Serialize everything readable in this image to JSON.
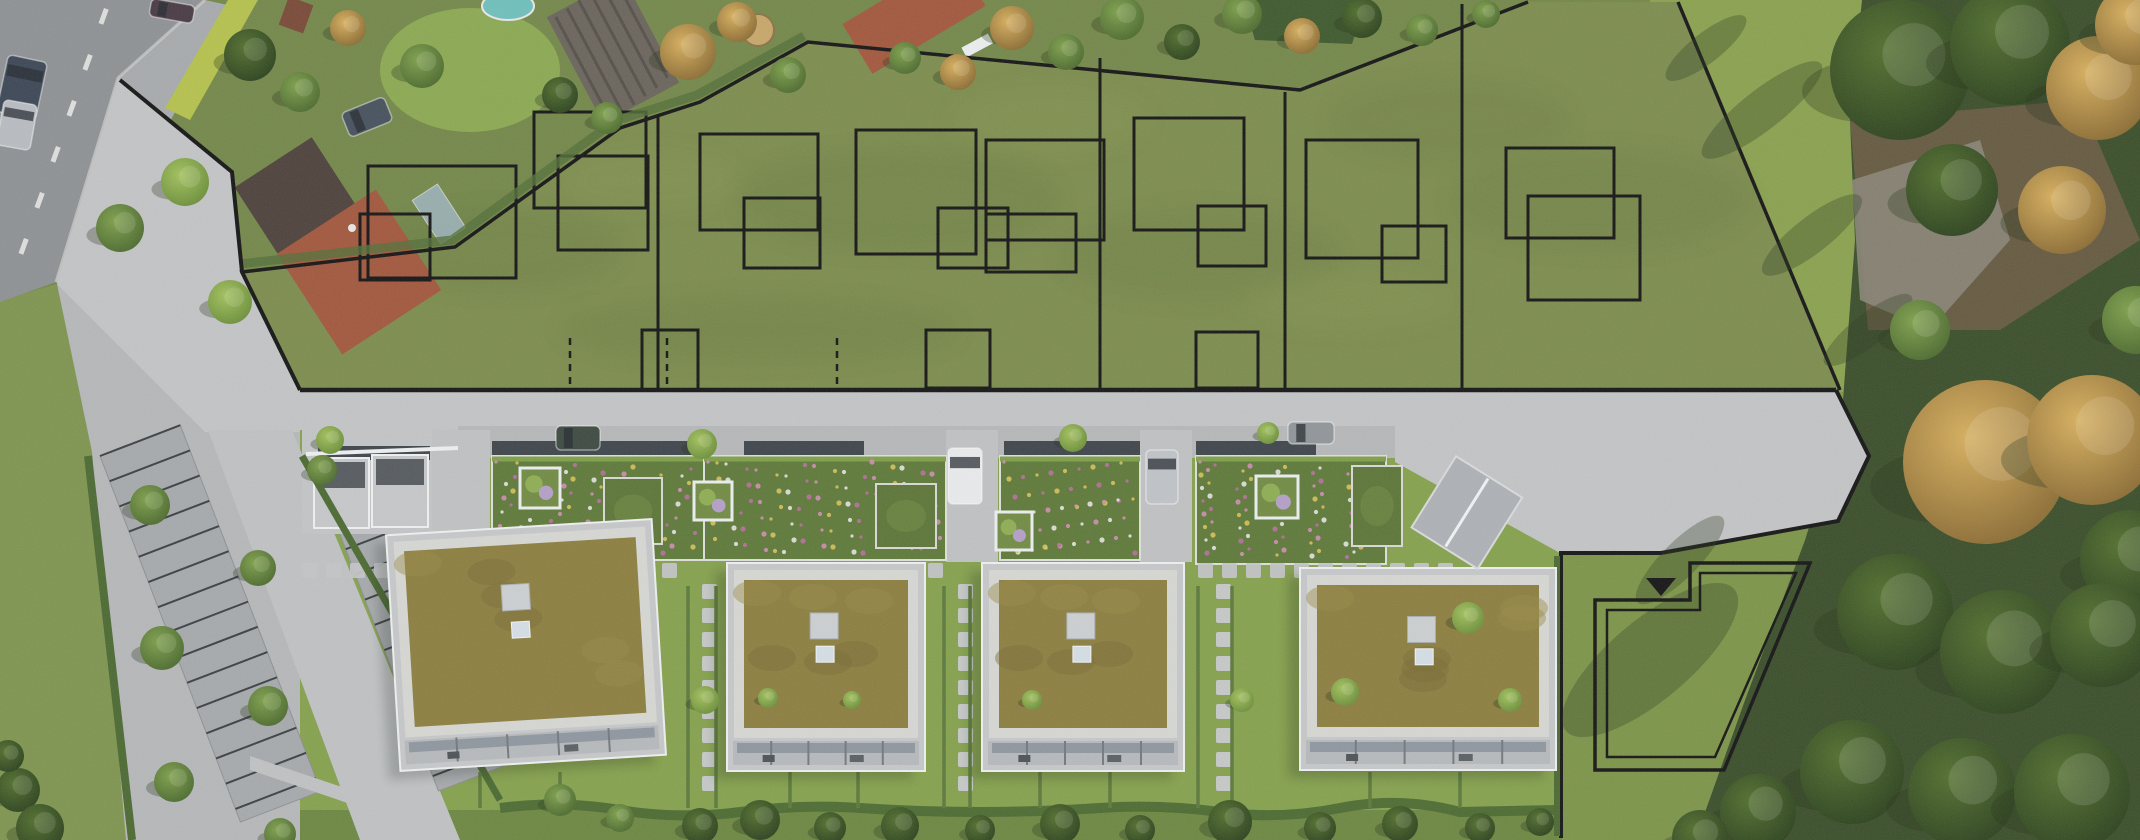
{
  "meta": {
    "description": "Aerial drone photograph of a new housing development: four flat-roof buildings with green sedum roofs along a new access road, a large olive-tinted field behind them overlaid with black plot boundaries and house footprint outlines, existing houses and gardens top-left, parking rows bottom-left, autumn woods on the right, and one reserved plot marked with a double outline and a triangle marker.",
    "image_type": "aerial-photograph-with-site-plan-overlay",
    "building_count": 4,
    "marked_plot_columns": 6
  },
  "palette": {
    "asphalt": "#8f9295",
    "shoulder": "#9a9a8a",
    "sidewalk": "#a8abae",
    "pavement": "#c4c5c7",
    "pavementDim": "#b6b8ba",
    "driveGray": "#c0c2c4",
    "field": "#7d8d4e",
    "gardenBase": "#74884a",
    "lawn": "#7f9550",
    "gardenLawn": "#86a24e",
    "meadow": "#8ba24f",
    "rightLawn": "#7d9549",
    "bottomStrip": "#6d8842",
    "sedum": "#8d7f40",
    "gravel": "#d7d8d4",
    "facade": "#c6c8ca",
    "glass": "#8b949c",
    "flower": "#5f7a3a",
    "hedge": "#4c6a32",
    "hedgeBright": "#b6c24e",
    "woods": "#3b4f2b",
    "rock": "#8a8578",
    "soil": "#6b5b44",
    "stall": "#a7aaad",
    "stallLine": "#3c4043",
    "line": "#161616",
    "white": "#eceff0",
    "pool": "#6fc0bc",
    "roofRed": "#a3583e",
    "roofDark": "#4e423c"
  },
  "scene": {
    "field_outline": "300,390 242,272 455,247 620,128 700,102 808,42 1300,90 1528,2 1678,2 1840,390",
    "plot_dividers": [
      {
        "x1": 658,
        "y1": 114,
        "x2": 658,
        "y2": 390
      },
      {
        "x1": 1100,
        "y1": 58,
        "x2": 1100,
        "y2": 390
      },
      {
        "x1": 1285,
        "y1": 92,
        "x2": 1285,
        "y2": 390
      },
      {
        "x1": 1462,
        "y1": 4,
        "x2": 1462,
        "y2": 390
      }
    ],
    "plot_dividers_dashed": [
      {
        "x1": 570,
        "y1": 338,
        "x2": 570,
        "y2": 390
      },
      {
        "x1": 667,
        "y1": 338,
        "x2": 667,
        "y2": 390
      },
      {
        "x1": 837,
        "y1": 338,
        "x2": 837,
        "y2": 390
      }
    ],
    "footprints": [
      {
        "x": 368,
        "y": 166,
        "w": 148,
        "h": 112
      },
      {
        "x": 360,
        "y": 214,
        "w": 70,
        "h": 66
      },
      {
        "x": 534,
        "y": 112,
        "w": 112,
        "h": 96
      },
      {
        "x": 558,
        "y": 156,
        "w": 90,
        "h": 94
      },
      {
        "x": 642,
        "y": 330,
        "w": 56,
        "h": 60
      },
      {
        "x": 700,
        "y": 134,
        "w": 118,
        "h": 96
      },
      {
        "x": 744,
        "y": 198,
        "w": 76,
        "h": 70
      },
      {
        "x": 856,
        "y": 130,
        "w": 120,
        "h": 124
      },
      {
        "x": 938,
        "y": 208,
        "w": 70,
        "h": 60
      },
      {
        "x": 926,
        "y": 330,
        "w": 64,
        "h": 58
      },
      {
        "x": 986,
        "y": 140,
        "w": 118,
        "h": 100
      },
      {
        "x": 986,
        "y": 214,
        "w": 90,
        "h": 58
      },
      {
        "x": 1134,
        "y": 118,
        "w": 110,
        "h": 112
      },
      {
        "x": 1198,
        "y": 206,
        "w": 68,
        "h": 60
      },
      {
        "x": 1196,
        "y": 332,
        "w": 62,
        "h": 56
      },
      {
        "x": 1306,
        "y": 140,
        "w": 112,
        "h": 118
      },
      {
        "x": 1382,
        "y": 226,
        "w": 64,
        "h": 56
      },
      {
        "x": 1506,
        "y": 148,
        "w": 108,
        "h": 90
      },
      {
        "x": 1528,
        "y": 196,
        "w": 112,
        "h": 104
      }
    ],
    "buildings": [
      {
        "x": 393,
        "y": 527,
        "w": 266,
        "h": 236,
        "rot": -3.5,
        "name": "building-1"
      },
      {
        "x": 727,
        "y": 563,
        "w": 198,
        "h": 208,
        "rot": 0,
        "name": "building-2"
      },
      {
        "x": 982,
        "y": 563,
        "w": 202,
        "h": 208,
        "rot": 0,
        "name": "building-3"
      },
      {
        "x": 1300,
        "y": 568,
        "w": 256,
        "h": 202,
        "rot": 0,
        "name": "building-4"
      }
    ],
    "flower_roofs": [
      {
        "x": 492,
        "y": 456,
        "w": 212,
        "h": 104
      },
      {
        "x": 704,
        "y": 456,
        "w": 242,
        "h": 104
      },
      {
        "x": 1000,
        "y": 456,
        "w": 140,
        "h": 104
      },
      {
        "x": 1196,
        "y": 456,
        "w": 190,
        "h": 108
      }
    ],
    "green_roofs": [
      {
        "x": 604,
        "y": 478,
        "w": 58,
        "h": 66
      },
      {
        "x": 876,
        "y": 484,
        "w": 60,
        "h": 64
      },
      {
        "x": 1352,
        "y": 466,
        "w": 50,
        "h": 80
      }
    ],
    "planters": [
      {
        "x": 520,
        "y": 468,
        "w": 40,
        "h": 40
      },
      {
        "x": 694,
        "y": 482,
        "w": 38,
        "h": 38
      },
      {
        "x": 996,
        "y": 512,
        "w": 36,
        "h": 38
      },
      {
        "x": 1256,
        "y": 476,
        "w": 42,
        "h": 42
      }
    ],
    "fences": [
      {
        "x": 492,
        "y": 441,
        "w": 210
      },
      {
        "x": 744,
        "y": 441,
        "w": 120
      },
      {
        "x": 1004,
        "y": 441,
        "w": 136
      },
      {
        "x": 1196,
        "y": 441,
        "w": 120
      },
      {
        "x": 318,
        "y": 446,
        "w": 112
      }
    ],
    "driveways": [
      {
        "x": 432,
        "y": 430,
        "w": 58,
        "h": 132
      },
      {
        "x": 946,
        "y": 430,
        "w": 52,
        "h": 132
      },
      {
        "x": 1140,
        "y": 430,
        "w": 52,
        "h": 132
      }
    ],
    "carports": [
      {
        "x": 314,
        "y": 458,
        "w": 55,
        "h": 70
      },
      {
        "x": 372,
        "y": 455,
        "w": 56,
        "h": 72
      }
    ],
    "paver_rows": {
      "y": 563,
      "size": 15,
      "gap": 24,
      "segments": [
        [
          302,
          700
        ],
        [
          760,
          948
        ],
        [
          1002,
          1144
        ],
        [
          1198,
          1456
        ]
      ]
    },
    "paver_paths": [
      {
        "x": 702,
        "y1": 584,
        "y2": 806
      },
      {
        "x": 958,
        "y1": 584,
        "y2": 806
      },
      {
        "x": 1216,
        "y1": 584,
        "y2": 806
      }
    ],
    "unit_hedges": [
      {
        "x": 688,
        "y1": 586,
        "y2": 808
      },
      {
        "x": 716,
        "y1": 586,
        "y2": 808
      },
      {
        "x": 944,
        "y1": 586,
        "y2": 808
      },
      {
        "x": 970,
        "y1": 586,
        "y2": 808
      },
      {
        "x": 1198,
        "y1": 586,
        "y2": 808
      },
      {
        "x": 1232,
        "y1": 586,
        "y2": 808
      },
      {
        "x": 480,
        "y1": 772,
        "y2": 808
      },
      {
        "x": 560,
        "y1": 772,
        "y2": 808
      },
      {
        "x": 790,
        "y1": 772,
        "y2": 808
      },
      {
        "x": 858,
        "y1": 772,
        "y2": 808
      },
      {
        "x": 1040,
        "y1": 772,
        "y2": 808
      },
      {
        "x": 1110,
        "y1": 772,
        "y2": 808
      },
      {
        "x": 1370,
        "y1": 772,
        "y2": 808
      },
      {
        "x": 1460,
        "y1": 772,
        "y2": 808
      }
    ],
    "stall_rows": [
      {
        "x": 100,
        "y": 456,
        "w": 86,
        "len": 392,
        "angle": -21,
        "sp": 27
      },
      {
        "x": 336,
        "y": 524,
        "w": 80,
        "len": 286,
        "angle": -21,
        "sp": 27
      }
    ],
    "road_dashes": [
      {
        "x": 104,
        "y": 8
      },
      {
        "x": 88,
        "y": 54
      },
      {
        "x": 72,
        "y": 100
      },
      {
        "x": 56,
        "y": 146
      },
      {
        "x": 40,
        "y": 192
      },
      {
        "x": 24,
        "y": 238
      }
    ],
    "cars": [
      {
        "x": 150,
        "y": 2,
        "w": 44,
        "h": 18,
        "r": 10,
        "o": "h",
        "c": "#4a3b45",
        "name": "car-maroon-road-top"
      },
      {
        "x": 2,
        "y": 58,
        "w": 40,
        "h": 58,
        "r": 12,
        "o": "v",
        "c": "#3c4756",
        "name": "van-dark-road"
      },
      {
        "x": 0,
        "y": 102,
        "w": 34,
        "h": 46,
        "r": 10,
        "o": "v",
        "c": "#b9bdc2",
        "name": "car-silver-road"
      },
      {
        "x": 344,
        "y": 104,
        "w": 46,
        "h": 26,
        "r": -22,
        "o": "h",
        "c": "#47525e",
        "name": "van-house-driveway"
      },
      {
        "x": 556,
        "y": 426,
        "w": 44,
        "h": 24,
        "r": 0,
        "o": "h",
        "c": "#3e4a42",
        "name": "car-green-parked"
      },
      {
        "x": 948,
        "y": 448,
        "w": 34,
        "h": 56,
        "r": 0,
        "o": "v",
        "c": "#e9ebed",
        "name": "car-white-driveway"
      },
      {
        "x": 1146,
        "y": 450,
        "w": 32,
        "h": 54,
        "r": 0,
        "o": "v",
        "c": "#c0c4c8",
        "name": "car-silver-driveway"
      },
      {
        "x": 1288,
        "y": 422,
        "w": 46,
        "h": 22,
        "r": 0,
        "o": "h",
        "c": "#91969b",
        "name": "car-gray-road"
      }
    ],
    "trees": [
      {
        "x": 250,
        "y": 55,
        "r": 26,
        "k": "d"
      },
      {
        "x": 300,
        "y": 92,
        "r": 20,
        "k": "g"
      },
      {
        "x": 348,
        "y": 28,
        "r": 18,
        "k": "a"
      },
      {
        "x": 422,
        "y": 66,
        "r": 22,
        "k": "g"
      },
      {
        "x": 560,
        "y": 95,
        "r": 18,
        "k": "d"
      },
      {
        "x": 607,
        "y": 118,
        "r": 16,
        "k": "g"
      },
      {
        "x": 688,
        "y": 52,
        "r": 28,
        "k": "a"
      },
      {
        "x": 737,
        "y": 22,
        "r": 20,
        "k": "a"
      },
      {
        "x": 788,
        "y": 75,
        "r": 18,
        "k": "g"
      },
      {
        "x": 905,
        "y": 58,
        "r": 16,
        "k": "g"
      },
      {
        "x": 958,
        "y": 72,
        "r": 18,
        "k": "a"
      },
      {
        "x": 1012,
        "y": 28,
        "r": 22,
        "k": "a"
      },
      {
        "x": 1066,
        "y": 52,
        "r": 18,
        "k": "g"
      },
      {
        "x": 1122,
        "y": 18,
        "r": 22,
        "k": "g"
      },
      {
        "x": 1182,
        "y": 42,
        "r": 18,
        "k": "d"
      },
      {
        "x": 1242,
        "y": 14,
        "r": 20,
        "k": "g"
      },
      {
        "x": 1302,
        "y": 36,
        "r": 18,
        "k": "a"
      },
      {
        "x": 1362,
        "y": 18,
        "r": 20,
        "k": "d"
      },
      {
        "x": 1422,
        "y": 30,
        "r": 16,
        "k": "g"
      },
      {
        "x": 1486,
        "y": 14,
        "r": 14,
        "k": "g"
      },
      {
        "x": 185,
        "y": 182,
        "r": 24,
        "k": "b"
      },
      {
        "x": 120,
        "y": 228,
        "r": 24,
        "k": "g"
      },
      {
        "x": 230,
        "y": 302,
        "r": 22,
        "k": "b"
      },
      {
        "x": 150,
        "y": 505,
        "r": 20,
        "k": "g"
      },
      {
        "x": 162,
        "y": 648,
        "r": 22,
        "k": "g"
      },
      {
        "x": 174,
        "y": 782,
        "r": 20,
        "k": "g"
      },
      {
        "x": 258,
        "y": 568,
        "r": 18,
        "k": "g"
      },
      {
        "x": 268,
        "y": 706,
        "r": 20,
        "k": "g"
      },
      {
        "x": 280,
        "y": 834,
        "r": 16,
        "k": "g"
      },
      {
        "x": 322,
        "y": 470,
        "r": 15,
        "k": "g"
      },
      {
        "x": 330,
        "y": 440,
        "r": 14,
        "k": "b"
      },
      {
        "x": 702,
        "y": 444,
        "r": 15,
        "k": "b"
      },
      {
        "x": 1073,
        "y": 438,
        "r": 14,
        "k": "b"
      },
      {
        "x": 1268,
        "y": 433,
        "r": 11,
        "k": "b"
      },
      {
        "x": 705,
        "y": 700,
        "r": 14,
        "k": "b"
      },
      {
        "x": 768,
        "y": 698,
        "r": 10,
        "k": "b"
      },
      {
        "x": 852,
        "y": 700,
        "r": 9,
        "k": "b"
      },
      {
        "x": 1032,
        "y": 700,
        "r": 10,
        "k": "b"
      },
      {
        "x": 1242,
        "y": 700,
        "r": 12,
        "k": "b"
      },
      {
        "x": 1345,
        "y": 692,
        "r": 14,
        "k": "b"
      },
      {
        "x": 1468,
        "y": 618,
        "r": 16,
        "k": "b"
      },
      {
        "x": 1510,
        "y": 700,
        "r": 12,
        "k": "b"
      },
      {
        "x": 560,
        "y": 800,
        "r": 16,
        "k": "g"
      },
      {
        "x": 620,
        "y": 818,
        "r": 14,
        "k": "g"
      },
      {
        "x": 700,
        "y": 826,
        "r": 18,
        "k": "d"
      },
      {
        "x": 760,
        "y": 820,
        "r": 20,
        "k": "d"
      },
      {
        "x": 830,
        "y": 828,
        "r": 16,
        "k": "d"
      },
      {
        "x": 900,
        "y": 826,
        "r": 19,
        "k": "d"
      },
      {
        "x": 980,
        "y": 830,
        "r": 15,
        "k": "d"
      },
      {
        "x": 1060,
        "y": 824,
        "r": 20,
        "k": "d"
      },
      {
        "x": 1140,
        "y": 830,
        "r": 15,
        "k": "d"
      },
      {
        "x": 1230,
        "y": 822,
        "r": 22,
        "k": "d"
      },
      {
        "x": 1320,
        "y": 828,
        "r": 16,
        "k": "d"
      },
      {
        "x": 1400,
        "y": 824,
        "r": 18,
        "k": "d"
      },
      {
        "x": 1480,
        "y": 828,
        "r": 15,
        "k": "d"
      },
      {
        "x": 1540,
        "y": 822,
        "r": 14,
        "k": "d"
      },
      {
        "x": 1900,
        "y": 70,
        "r": 70,
        "k": "d"
      },
      {
        "x": 2010,
        "y": 45,
        "r": 60,
        "k": "d"
      },
      {
        "x": 2098,
        "y": 88,
        "r": 52,
        "k": "a"
      },
      {
        "x": 2135,
        "y": 25,
        "r": 40,
        "k": "a"
      },
      {
        "x": 1952,
        "y": 190,
        "r": 46,
        "k": "d"
      },
      {
        "x": 2062,
        "y": 210,
        "r": 44,
        "k": "a"
      },
      {
        "x": 1985,
        "y": 462,
        "r": 82,
        "k": "a"
      },
      {
        "x": 2092,
        "y": 440,
        "r": 65,
        "k": "a"
      },
      {
        "x": 2130,
        "y": 560,
        "r": 50,
        "k": "d"
      },
      {
        "x": 1895,
        "y": 612,
        "r": 58,
        "k": "d"
      },
      {
        "x": 2002,
        "y": 652,
        "r": 62,
        "k": "d"
      },
      {
        "x": 2102,
        "y": 635,
        "r": 52,
        "k": "d"
      },
      {
        "x": 1852,
        "y": 772,
        "r": 52,
        "k": "d"
      },
      {
        "x": 1962,
        "y": 792,
        "r": 54,
        "k": "d"
      },
      {
        "x": 2072,
        "y": 792,
        "r": 58,
        "k": "d"
      },
      {
        "x": 1758,
        "y": 812,
        "r": 38,
        "k": "d"
      },
      {
        "x": 1700,
        "y": 838,
        "r": 28,
        "k": "d"
      },
      {
        "x": 1920,
        "y": 330,
        "r": 30,
        "k": "g"
      },
      {
        "x": 2136,
        "y": 320,
        "r": 34,
        "k": "g"
      },
      {
        "x": 18,
        "y": 790,
        "r": 22,
        "k": "d"
      },
      {
        "x": 40,
        "y": 828,
        "r": 24,
        "k": "d"
      },
      {
        "x": 8,
        "y": 756,
        "r": 16,
        "k": "d"
      }
    ],
    "meadow_shadows": [
      {
        "x": 1762,
        "y": 110,
        "rx": 75,
        "ry": 20,
        "r": -38
      },
      {
        "x": 1812,
        "y": 235,
        "rx": 62,
        "ry": 18,
        "r": -38
      },
      {
        "x": 1706,
        "y": 48,
        "rx": 50,
        "ry": 15,
        "r": -38
      },
      {
        "x": 1868,
        "y": 330,
        "rx": 55,
        "ry": 16,
        "r": -38
      },
      {
        "x": 1650,
        "y": 660,
        "rx": 110,
        "ry": 40,
        "r": -40
      },
      {
        "x": 1680,
        "y": 560,
        "rx": 60,
        "ry": 18,
        "r": -45
      }
    ],
    "marker_triangle": "1646,578 1676,578 1661,596",
    "reserved_plot": {
      "outer": "1595,600 1690,600 1690,563 1810,563 1724,770 1595,770",
      "inner": "1607,610 1700,610 1700,573 1796,573 1715,757 1607,757"
    }
  }
}
